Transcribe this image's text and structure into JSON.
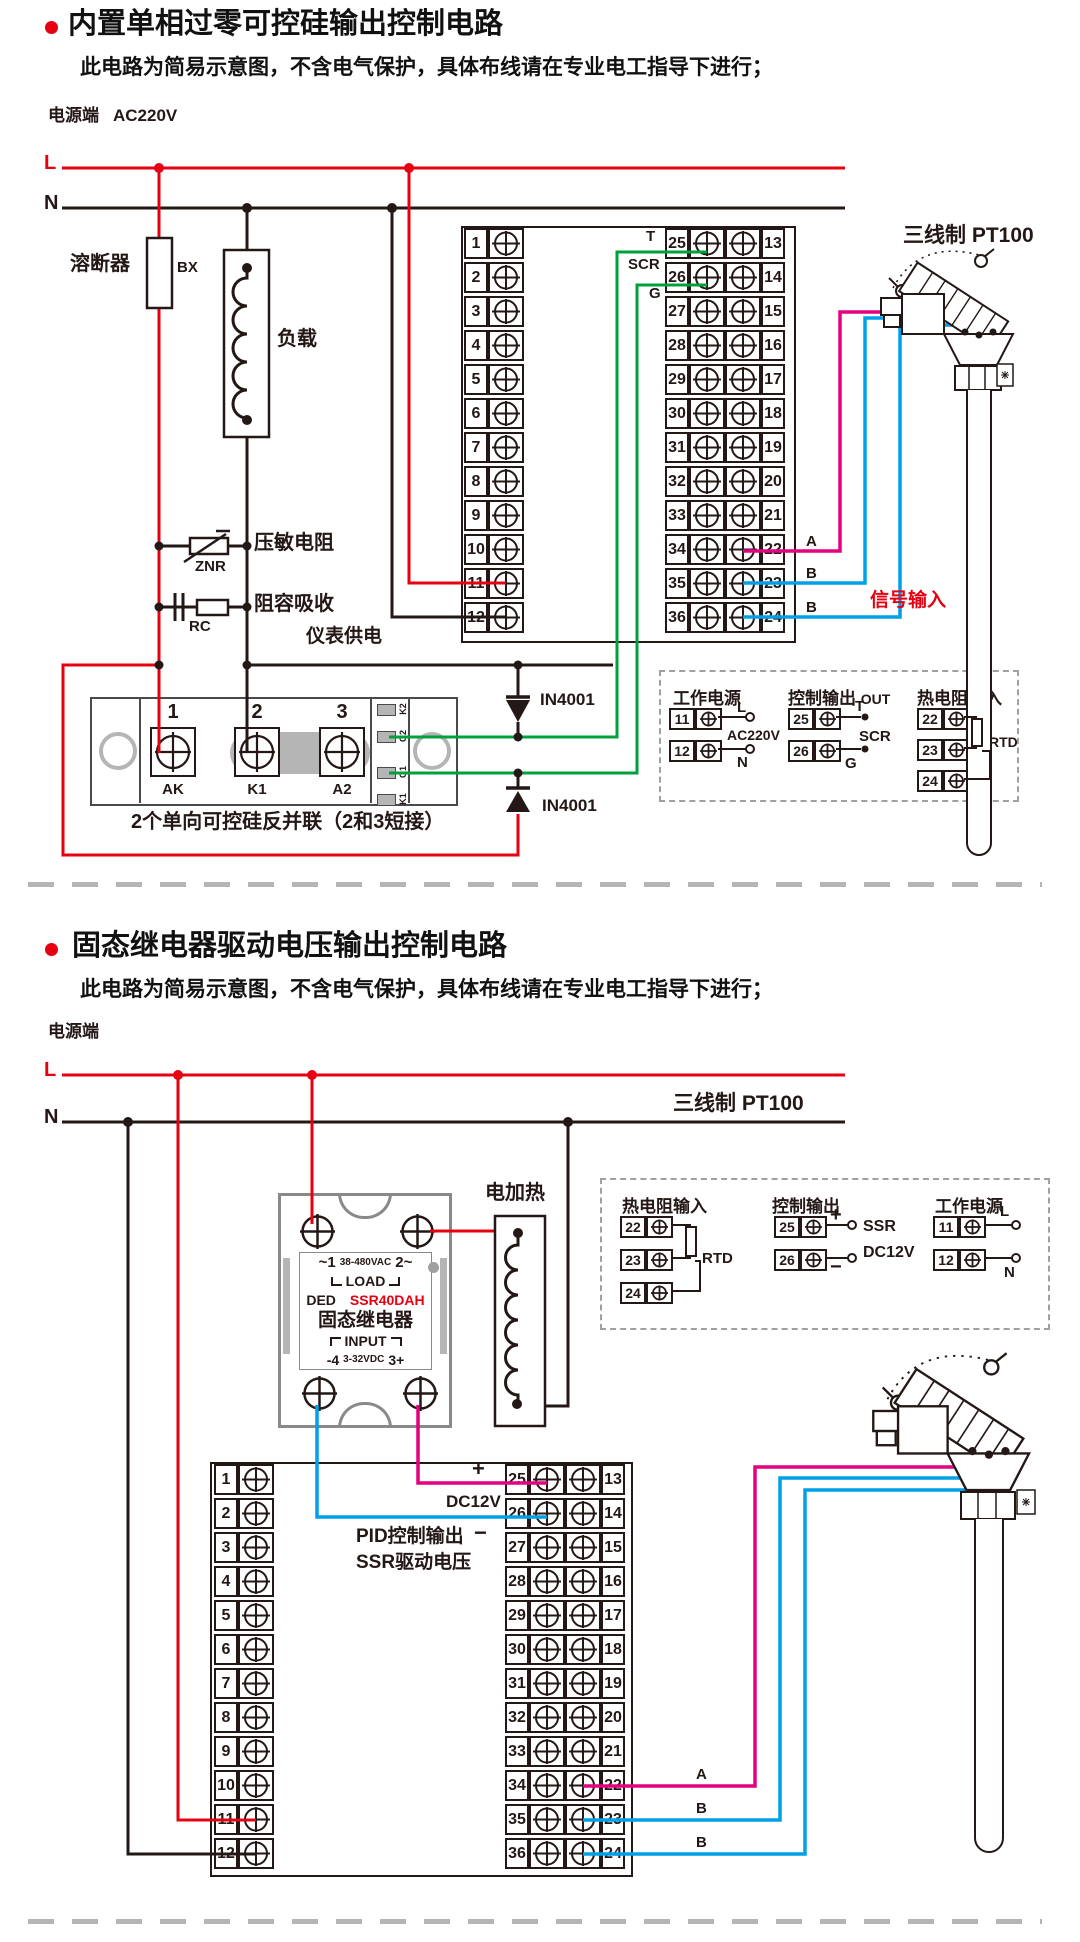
{
  "colors": {
    "red": "#e60012",
    "black": "#231815",
    "green": "#00a03c",
    "magenta": "#e4007f",
    "blue": "#00a0e9",
    "gray": "#9fa0a0"
  },
  "s1": {
    "title": "内置单相过零可控硅输出控制电路",
    "subtitle": "此电路为简易示意图，不含电气保护，具体布线请在专业电工指导下进行；",
    "power_label": "电源端",
    "voltage": "AC220V",
    "l": "L",
    "n": "N",
    "fuse_label": "溶断器",
    "fuse_code": "BX",
    "load_label": "负载",
    "znr_label": "压敏电阻",
    "znr_code": "ZNR",
    "rc_label": "阻容吸收",
    "rc_code": "RC",
    "meter_supply": "仪表供电",
    "tb_left": [
      "1",
      "2",
      "3",
      "4",
      "5",
      "6",
      "7",
      "8",
      "9",
      "10",
      "11",
      "12"
    ],
    "tb_mid": [
      "25",
      "26",
      "27",
      "28",
      "29",
      "30",
      "31",
      "32",
      "33",
      "34",
      "35",
      "36"
    ],
    "tb_right": [
      "13",
      "14",
      "15",
      "16",
      "17",
      "18",
      "19",
      "20",
      "21",
      "22",
      "23",
      "24"
    ],
    "t": "T",
    "scr": "SCR",
    "g": "G",
    "diode1": "IN4001",
    "diode2": "IN4001",
    "module": {
      "n1": "1",
      "n2": "2",
      "n3": "3",
      "p1": "AK",
      "p2": "K1",
      "p3": "A2",
      "s1": "K2",
      "s2": "G2",
      "s3": "G1",
      "s4": "K1",
      "caption": "2个单向可控硅反并联（2和3短接）"
    },
    "sig_a": "A",
    "sig_b1": "B",
    "sig_b2": "B",
    "signal_input": "信号输入",
    "pt100": "三线制 PT100",
    "legend": {
      "power": {
        "title": "工作电源",
        "r1": "11",
        "r2": "12",
        "l": "L",
        "n": "N",
        "mid": "AC220V"
      },
      "out": {
        "title": "控制输出",
        "out": "OUT",
        "r1": "25",
        "r2": "26",
        "t": "T",
        "mid": "SCR",
        "g": "G"
      },
      "rtd": {
        "title": "热电阻输入",
        "r1": "22",
        "r2": "23",
        "r3": "24",
        "code": "RTD"
      }
    }
  },
  "s2": {
    "title": "固态继电器驱动电压输出控制电路",
    "subtitle": "此电路为简易示意图，不含电气保护，具体布线请在专业电工指导下进行；",
    "power_label": "电源端",
    "l": "L",
    "n": "N",
    "heater_label": "电加热",
    "ssr": {
      "ac_l": "~1",
      "ac_mid": "38-480VAC",
      "ac_r": "2~",
      "load": "LOAD",
      "brand": "DED",
      "model": "SSR40DAH",
      "name": "固态继电器",
      "input": "INPUT",
      "dc_l": "-4",
      "dc_mid": "3-32VDC",
      "dc_r": "3+"
    },
    "plus": "+",
    "minus": "−",
    "dc12v": "DC12V",
    "pid1": "PID控制输出",
    "pid2": "SSR驱动电压",
    "tb_left": [
      "1",
      "2",
      "3",
      "4",
      "5",
      "6",
      "7",
      "8",
      "9",
      "10",
      "11",
      "12"
    ],
    "tb_mid": [
      "25",
      "26",
      "27",
      "28",
      "29",
      "30",
      "31",
      "32",
      "33",
      "34",
      "35",
      "36"
    ],
    "tb_right": [
      "13",
      "14",
      "15",
      "16",
      "17",
      "18",
      "19",
      "20",
      "21",
      "22",
      "23",
      "24"
    ],
    "sig_a": "A",
    "sig_b1": "B",
    "sig_b2": "B",
    "pt100": "三线制 PT100",
    "legend": {
      "rtd": {
        "title": "热电阻输入",
        "r1": "22",
        "r2": "23",
        "r3": "24",
        "code": "RTD"
      },
      "out": {
        "title": "控制输出",
        "r1": "25",
        "r2": "26",
        "plus": "+",
        "minus": "−",
        "t1": "SSR",
        "t2": "DC12V"
      },
      "power": {
        "title": "工作电源",
        "r1": "11",
        "r2": "12",
        "l": "L",
        "n": "N"
      }
    }
  }
}
